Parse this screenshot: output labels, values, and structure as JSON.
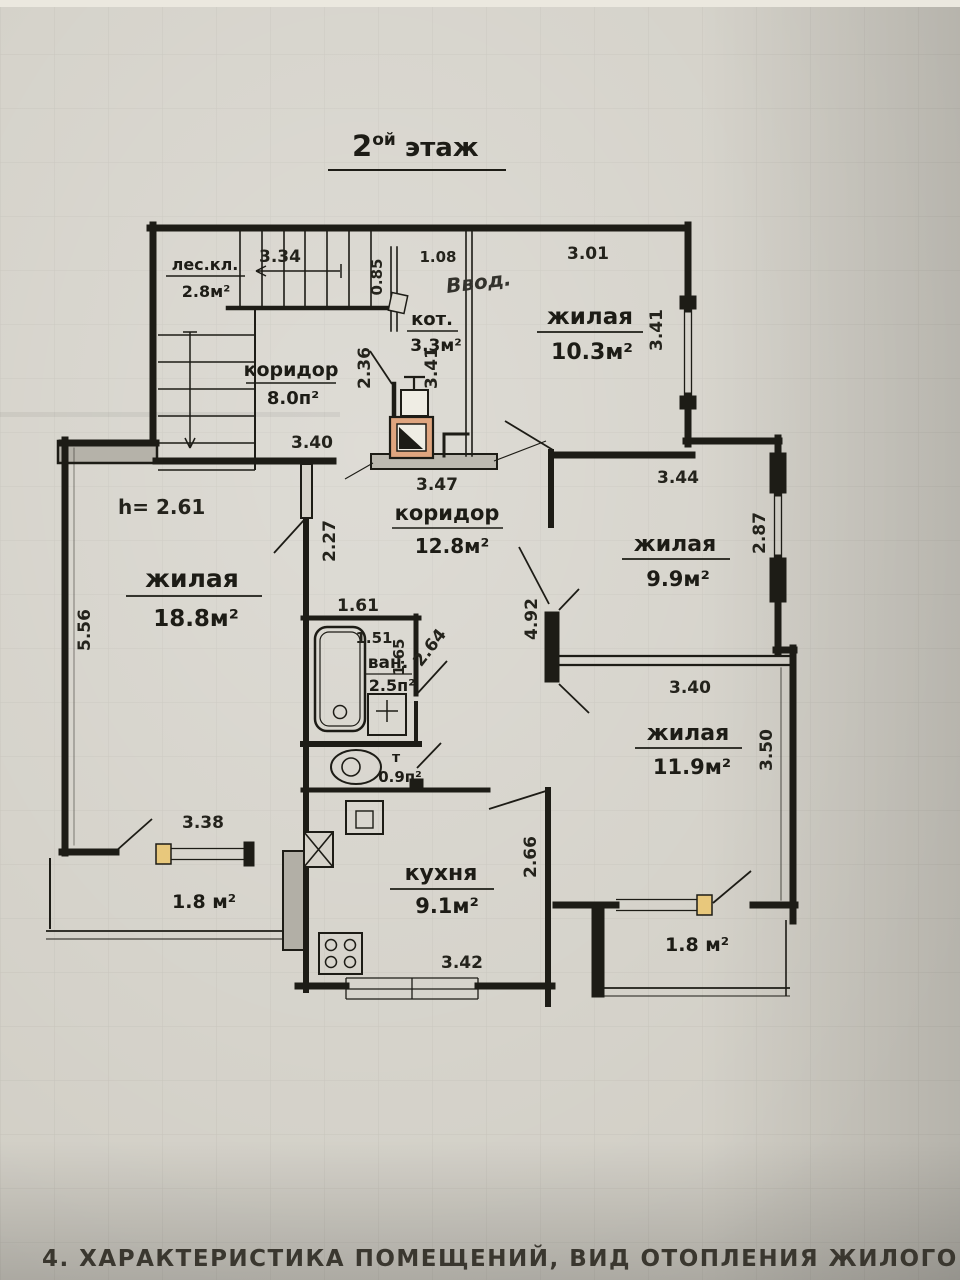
{
  "titles": {
    "floor_num": "2",
    "floor_sup": "ой",
    "floor_word": "этаж",
    "section": "4. ХАРАКТЕРИСТИКА ПОМЕЩЕНИЙ, ВИД ОТОПЛЕНИЯ ЖИЛОГО ДОМА"
  },
  "notes": {
    "ceiling_height": "h= 2.61",
    "utility_entry": "Ввод."
  },
  "rooms": {
    "stairwell": {
      "name": "лес.кл.",
      "area": "2.8м²"
    },
    "corridor_upper": {
      "name": "коридор",
      "area": "8.0п²"
    },
    "boiler": {
      "name": "кот.",
      "area": "3.3м²"
    },
    "living_top": {
      "name": "жилая",
      "area": "10.3м²"
    },
    "corridor_main": {
      "name": "коридор",
      "area": "12.8м²"
    },
    "living_left": {
      "name": "жилая",
      "area": "18.8м²"
    },
    "living_right": {
      "name": "жилая",
      "area": "9.9м²"
    },
    "bathroom": {
      "name": "ван.",
      "area": "2.5п²"
    },
    "toilet": {
      "name": "т",
      "area": "0.9п²"
    },
    "living_bottom": {
      "name": "жилая",
      "area": "11.9м²"
    },
    "kitchen": {
      "name": "кухня",
      "area": "9.1м²"
    },
    "balcony_left": {
      "area": "1.8 м²"
    },
    "balcony_right": {
      "area": "1.8 м²"
    }
  },
  "dims": {
    "stair_flight": "3.34",
    "entry_gap": "0.85",
    "entry_width": "1.08",
    "living_top_width": "3.01",
    "living_top_depth": "3.41",
    "corridor_nook": "2.36",
    "boiler_depth": "3.41",
    "living_left_width": "3.40",
    "stove_platform": "3.47",
    "living_left_door": "2.27",
    "living_right_width": "3.44",
    "living_right_depth": "2.87",
    "bath_width": "1.61",
    "bath_inner_width": "1.51",
    "bath_inner_depth": "1.65",
    "bath_diagonal": "2.64",
    "corridor_depth": "4.92",
    "living_bottom_width": "3.40",
    "living_bottom_depth": "3.50",
    "living_left_depth": "5.56",
    "balcony_left_width": "3.38",
    "kitchen_depth": "2.66",
    "kitchen_width": "3.42"
  },
  "colors": {
    "ink": "#1d1c16",
    "stove_accent": "#dfa57f",
    "window_accent": "#e8c87c",
    "paper": "#d1cec5"
  }
}
